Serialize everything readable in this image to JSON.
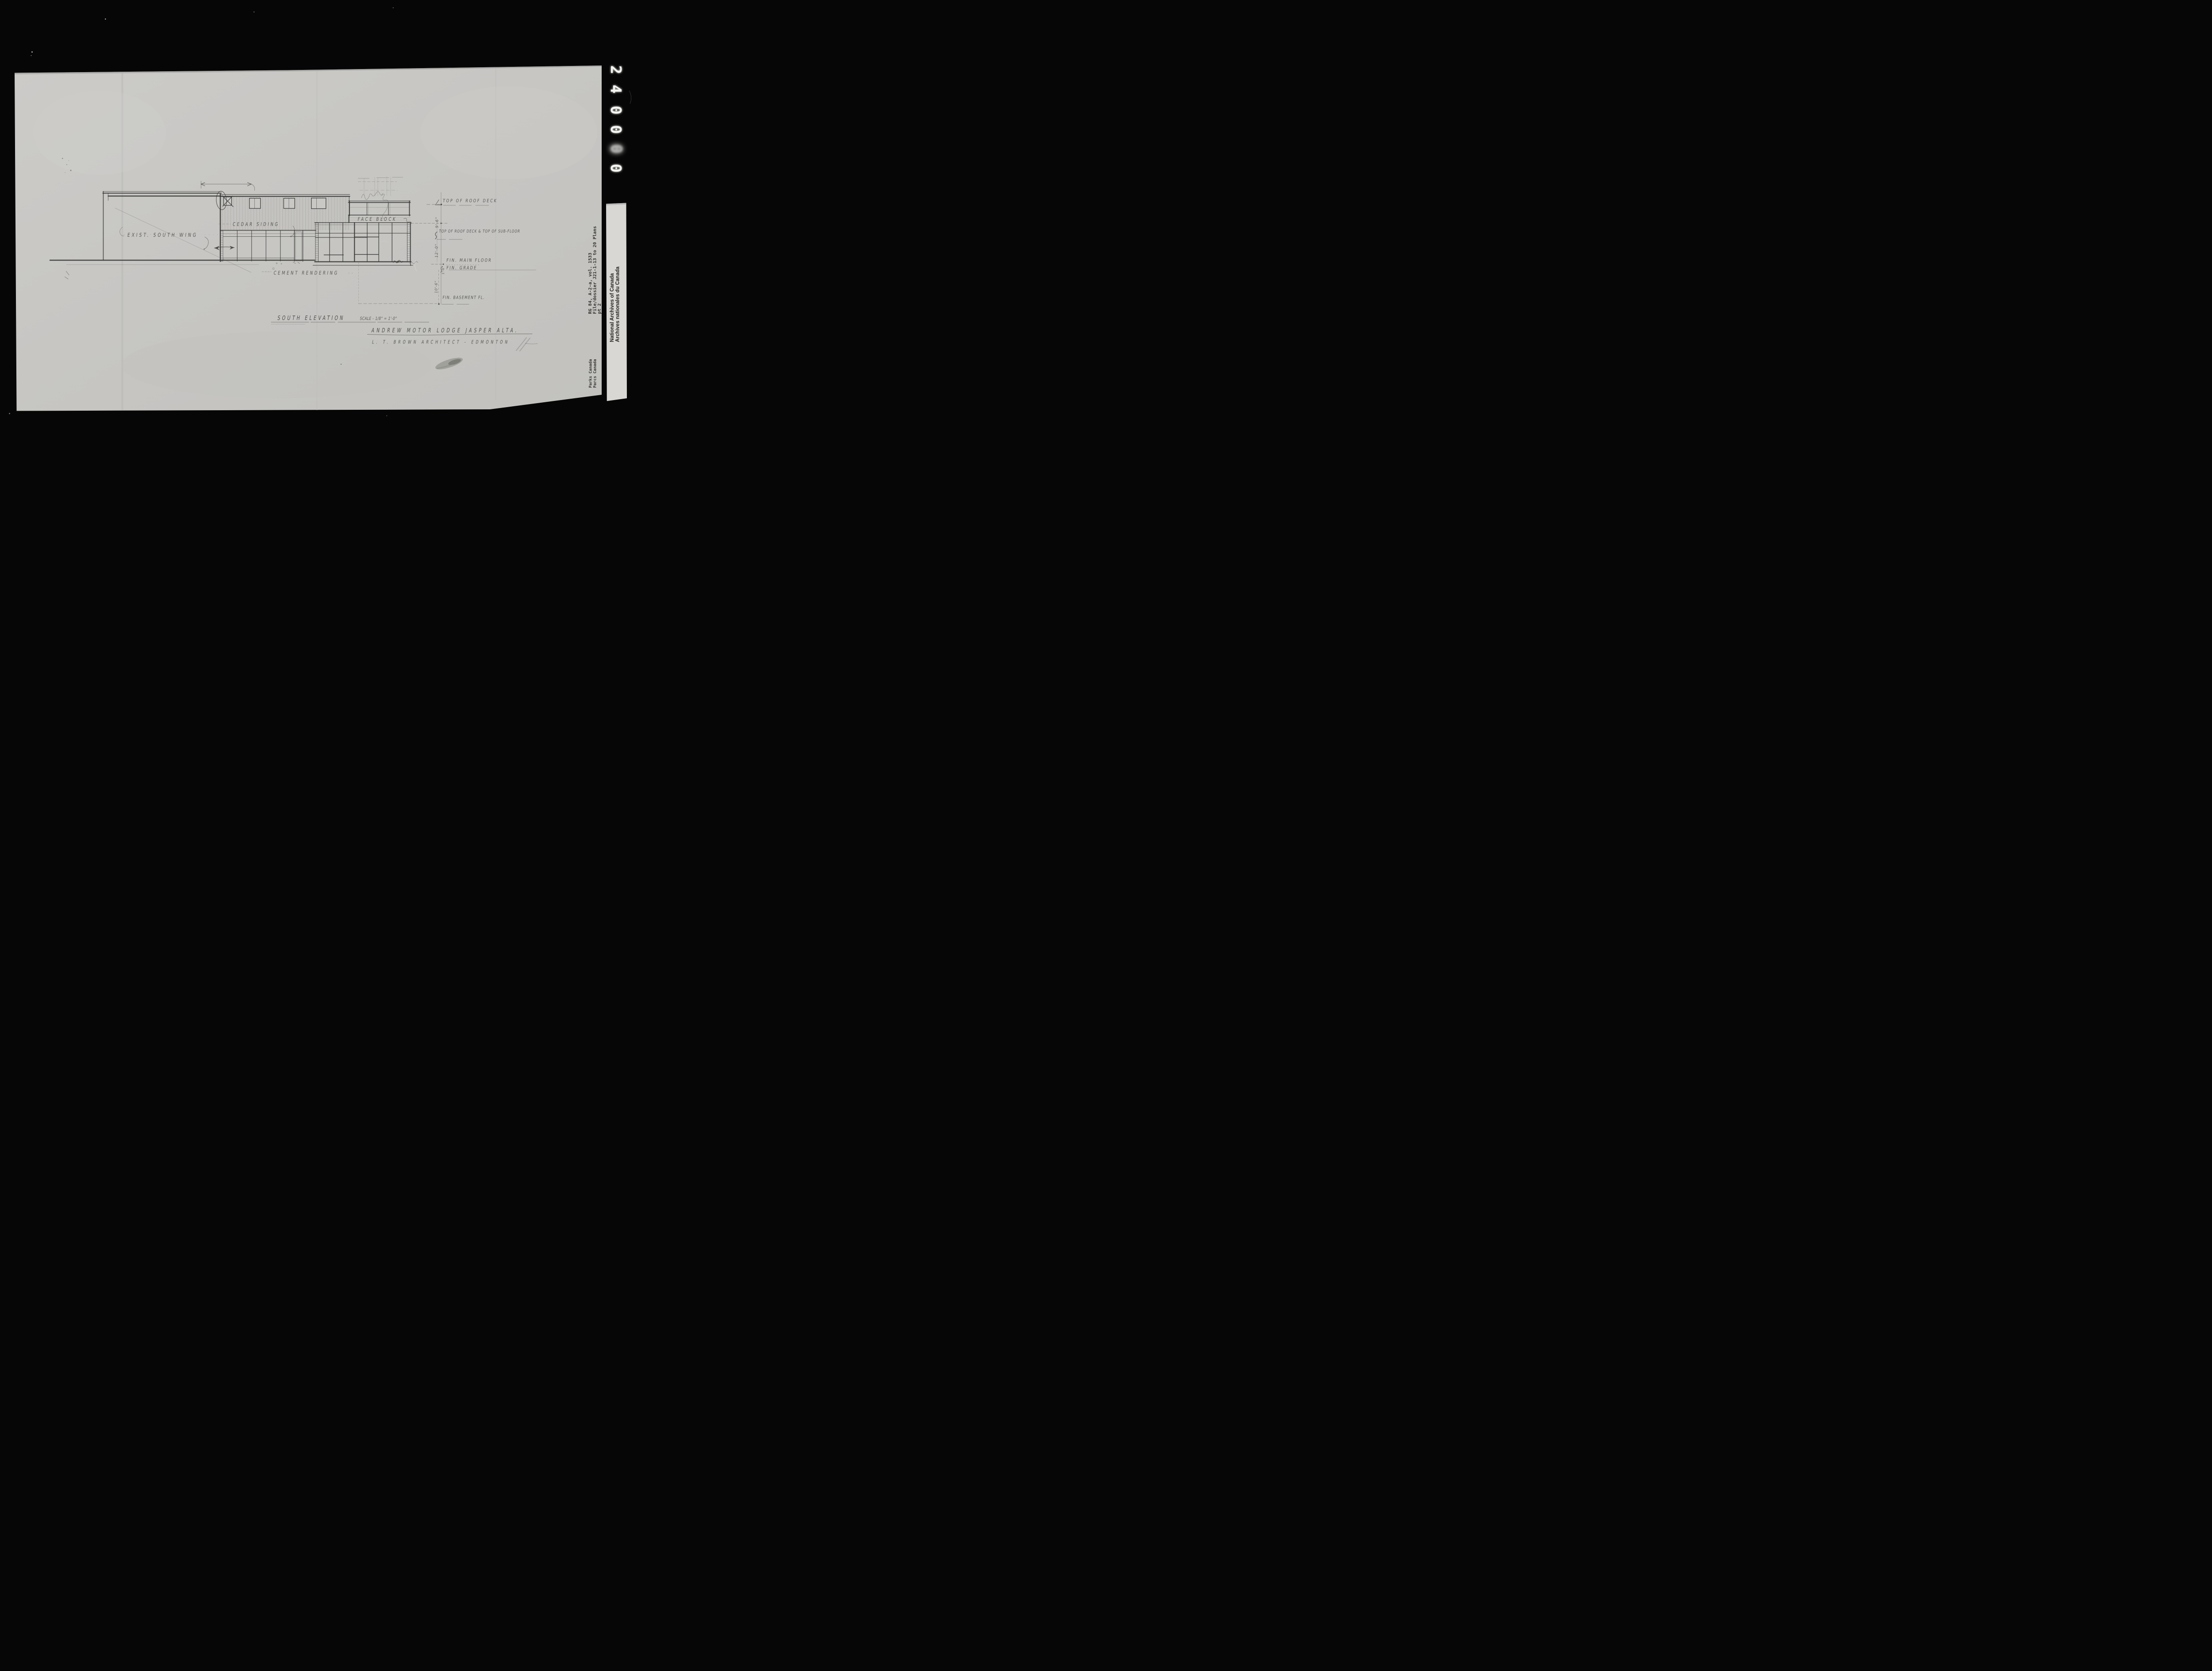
{
  "film": {
    "counter_digits": [
      "2",
      "4",
      "0",
      "0",
      "0",
      "0"
    ]
  },
  "archive_strip": {
    "reference": {
      "line1": "RG 84, A-2-a, vol. 1533",
      "line2": "File/dossier J21-1-13 to 20 Plans",
      "line3": "pt 2"
    },
    "institution": {
      "english": "National Archives of Canada",
      "french": "Archives nationales du Canada"
    },
    "agency": {
      "english": "Parks Canada",
      "french": "Parcs Canada"
    }
  },
  "drawing": {
    "wall_labels": {
      "existing_wing": "EXIST. SOUTH WING",
      "cedar_siding": "CEDAR SIDING",
      "face_block": "FACE BLOCK",
      "cement_rendering": "CEMENT RENDERING"
    },
    "level_labels": {
      "roof_deck": "TOP OF ROOF DECK",
      "sub_floor": "TOP OF ROOF DECK & TOP OF SUB-FLOOR",
      "main_floor": "FIN. MAIN FLOOR",
      "grade": "FIN. GRADE",
      "basement": "FIN. BASEMENT FL."
    },
    "dimensions": {
      "upper": "9'-6\"",
      "storey": "12'-0\"",
      "floor_to_grade": "1'-6\"",
      "basement_depth": "10'-6\""
    },
    "view_title": "SOUTH ELEVATION",
    "view_scale": "SCALE - 1/8\" = 1'-0\"",
    "project_title": "ANDREW MOTOR LODGE JASPER ALTA.",
    "architect": "L. T. BROWN ARCHITECT - EDMONTON"
  },
  "colors": {
    "film_black": "#060606",
    "sheet_grey": "#c7c6c3",
    "card_white": "#d8d7d4",
    "pencil": "#3a3a38",
    "counter_glow": "#f5f5f2"
  }
}
